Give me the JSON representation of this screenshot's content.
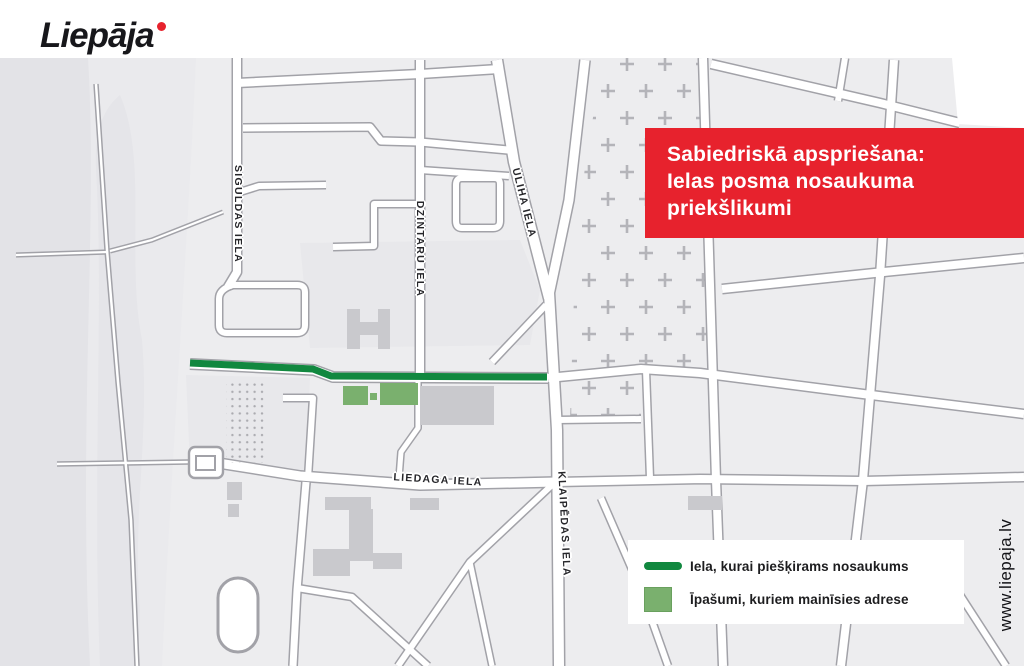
{
  "logo": {
    "wordmark": "Liepāja"
  },
  "banner": {
    "bg_color": "#e7222d",
    "lines": [
      "Sabiedriskā apspriešana:",
      "Ielas posma nosaukuma",
      "priekšlikumi"
    ]
  },
  "map": {
    "street_labels": [
      {
        "id": "siguldas",
        "text": "SIGULDAS IELA"
      },
      {
        "id": "dzintaru",
        "text": "DZINTARU IELA"
      },
      {
        "id": "uliha",
        "text": "ULIHA IELA"
      },
      {
        "id": "liedaga",
        "text": "LIEDAGA IELA"
      },
      {
        "id": "klaipedas",
        "text": "KLAIPĒDAS IELA"
      }
    ],
    "highlight": {
      "line_color": "#11883f",
      "property_color": "#7ab06e"
    }
  },
  "legend": {
    "items": [
      {
        "swatch": "line",
        "label": "Iela, kurai piešķirams nosaukums"
      },
      {
        "swatch": "square",
        "label": "Īpašumi, kuriem mainīsies adrese"
      }
    ]
  },
  "footer": {
    "website": "www.liepaja.lv"
  }
}
